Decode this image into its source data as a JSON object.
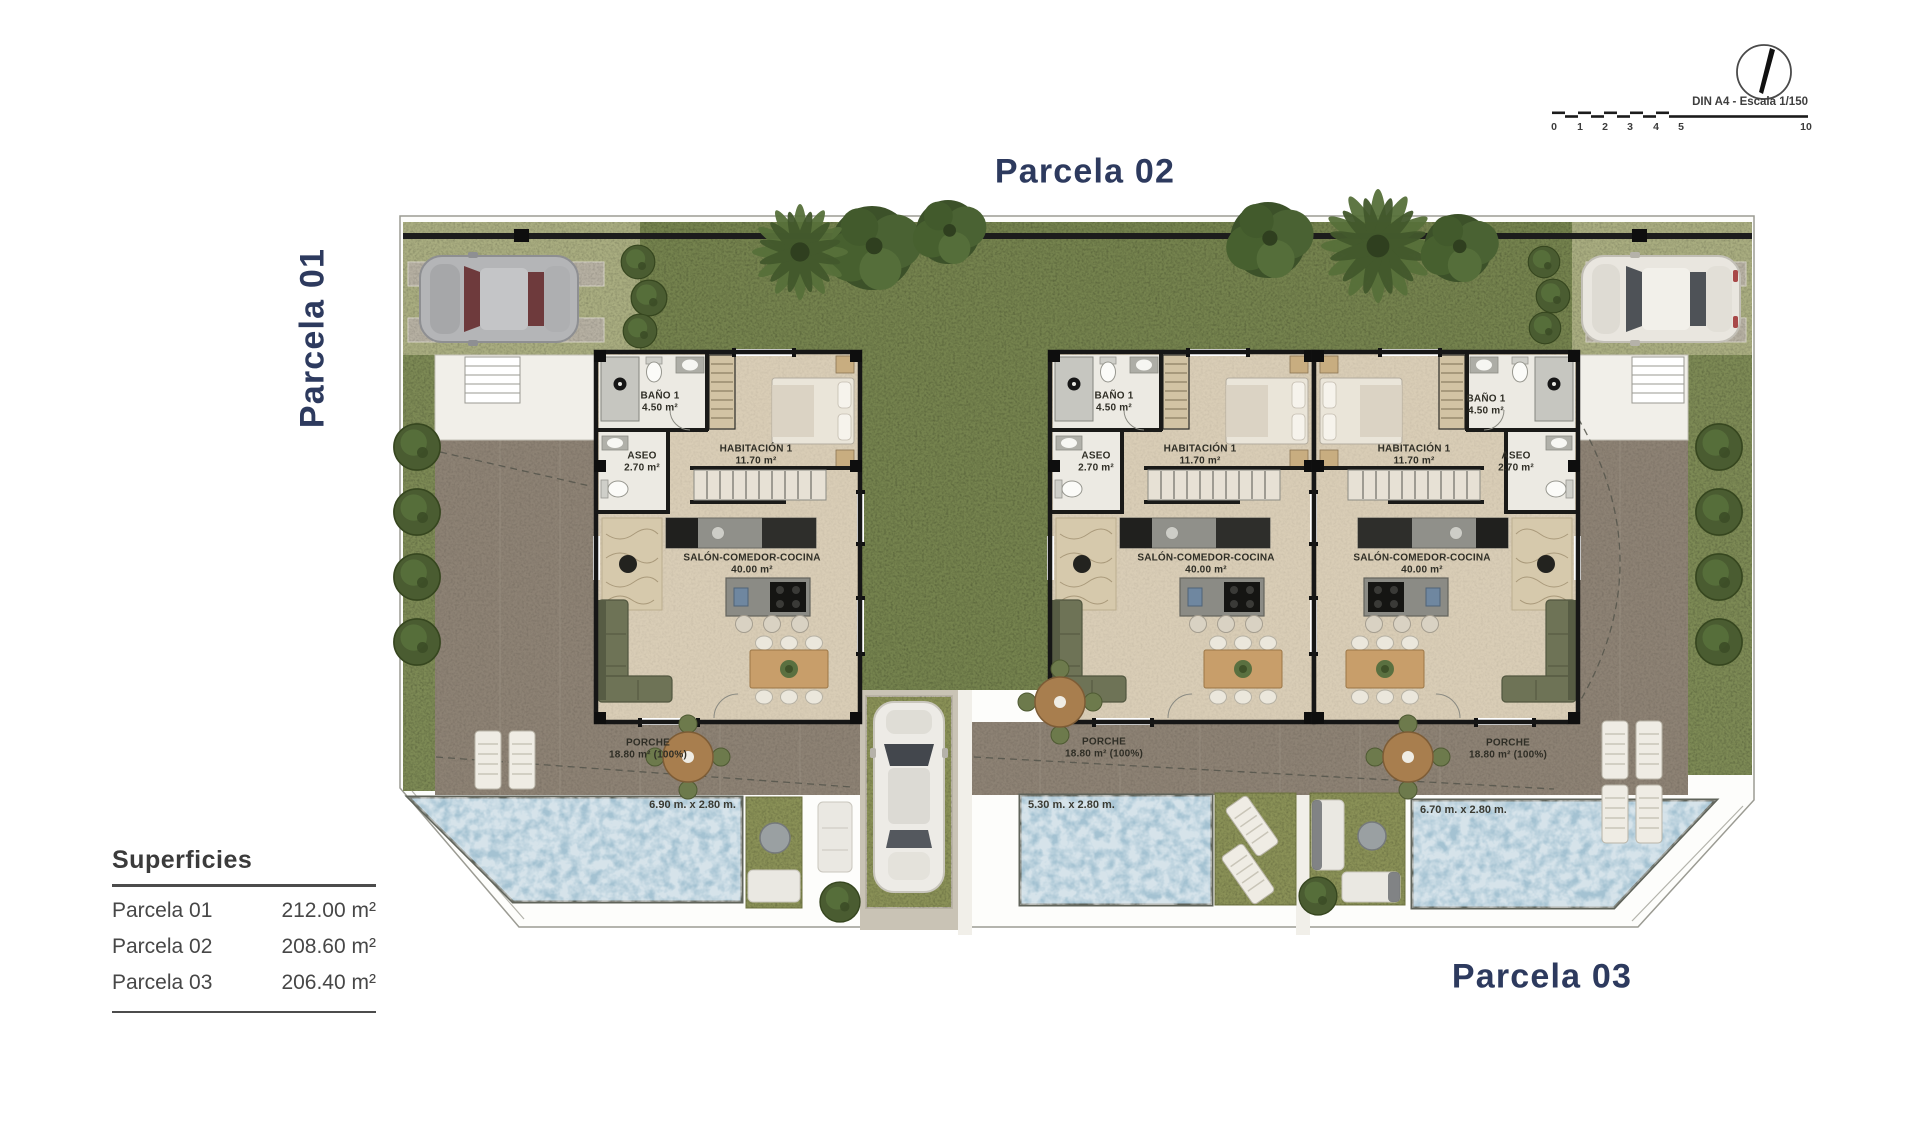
{
  "titles": {
    "parcel_01": "Parcela 01",
    "parcel_02": "Parcela 02",
    "parcel_03": "Parcela 03"
  },
  "scale_bar": {
    "label": "DIN A4 - Escala 1/150",
    "ticks": [
      "0",
      "1",
      "2",
      "3",
      "4",
      "5",
      "10"
    ]
  },
  "legend": {
    "title": "Superficies",
    "rows": [
      {
        "label": "Parcela 01",
        "value": "212.00 m²"
      },
      {
        "label": "Parcela 02",
        "value": "208.60 m²"
      },
      {
        "label": "Parcela 03",
        "value": "206.40 m²"
      }
    ]
  },
  "houses": [
    {
      "bano": {
        "name": "BAÑO 1",
        "area": "4.50 m²"
      },
      "aseo": {
        "name": "ASEO",
        "area": "2.70 m²"
      },
      "habitacion": {
        "name": "HABITACIÓN 1",
        "area": "11.70 m²"
      },
      "salon": {
        "name": "SALÓN-COMEDOR-COCINA",
        "area": "40.00 m²"
      },
      "porche": {
        "name": "PORCHE",
        "area": "18.80 m² (100%)"
      }
    },
    {
      "bano": {
        "name": "BAÑO 1",
        "area": "4.50 m²"
      },
      "aseo": {
        "name": "ASEO",
        "area": "2.70 m²"
      },
      "habitacion": {
        "name": "HABITACIÓN 1",
        "area": "11.70 m²"
      },
      "salon": {
        "name": "SALÓN-COMEDOR-COCINA",
        "area": "40.00 m²"
      },
      "porche": {
        "name": "PORCHE",
        "area": "18.80 m² (100%)"
      }
    },
    {
      "bano": {
        "name": "BAÑO 1",
        "area": "4.50 m²"
      },
      "aseo": {
        "name": "ASEO",
        "area": "2.70 m²"
      },
      "habitacion": {
        "name": "HABITACIÓN 1",
        "area": "11.70 m²"
      },
      "salon": {
        "name": "SALÓN-COMEDOR-COCINA",
        "area": "40.00 m²"
      },
      "porche": {
        "name": "PORCHE",
        "area": "18.80 m² (100%)"
      }
    }
  ],
  "pools": [
    {
      "size": "6.90 m. x 2.80 m."
    },
    {
      "size": "5.30 m. x 2.80 m."
    },
    {
      "size": "6.70 m. x 2.80 m."
    }
  ],
  "colors": {
    "accent_navy": "#2d3a5e",
    "grass": "#75834e",
    "pavement": "#8d8274",
    "pool_water": "#a4c2d2",
    "house_interior": "#d9cdb6"
  }
}
